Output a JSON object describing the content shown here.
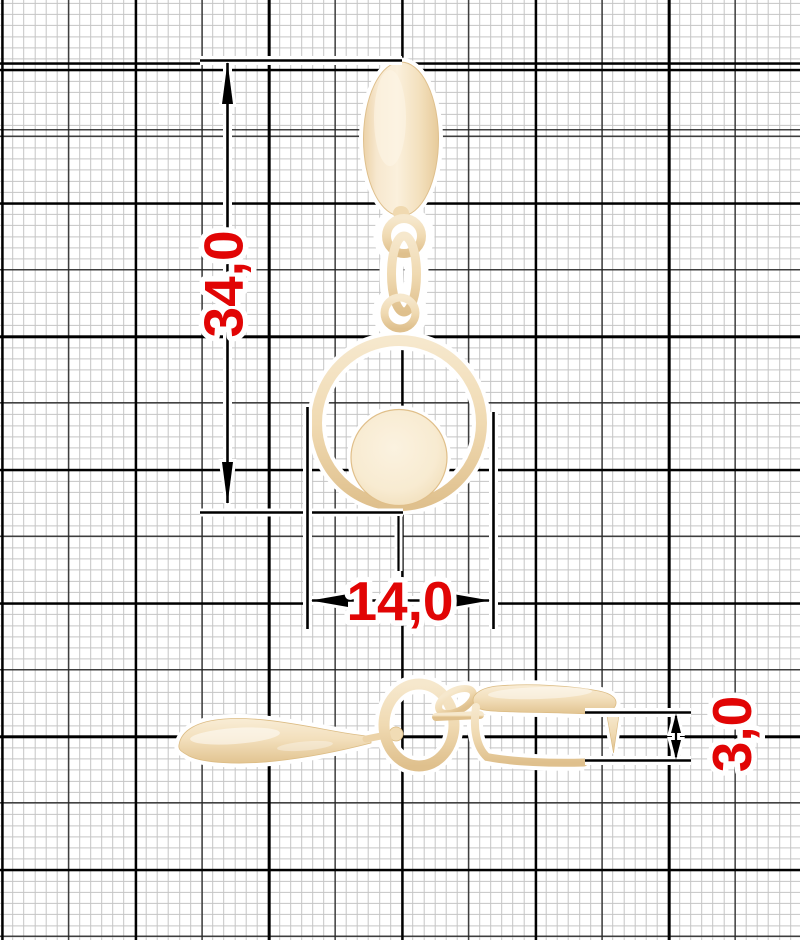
{
  "dims": {
    "total_height": "34,0",
    "diameter": "14,0",
    "thickness": "3,0"
  },
  "colors": {
    "dimension_text": "#e10505",
    "line": "#000000",
    "metal_light": "#fbf0dc",
    "metal": "#f3e0bd",
    "metal_dark": "#dfc08d",
    "grid_fine": "#c5c5c5",
    "grid_medium": "#232323",
    "grid_major": "#000000",
    "background": "#ffffff"
  }
}
